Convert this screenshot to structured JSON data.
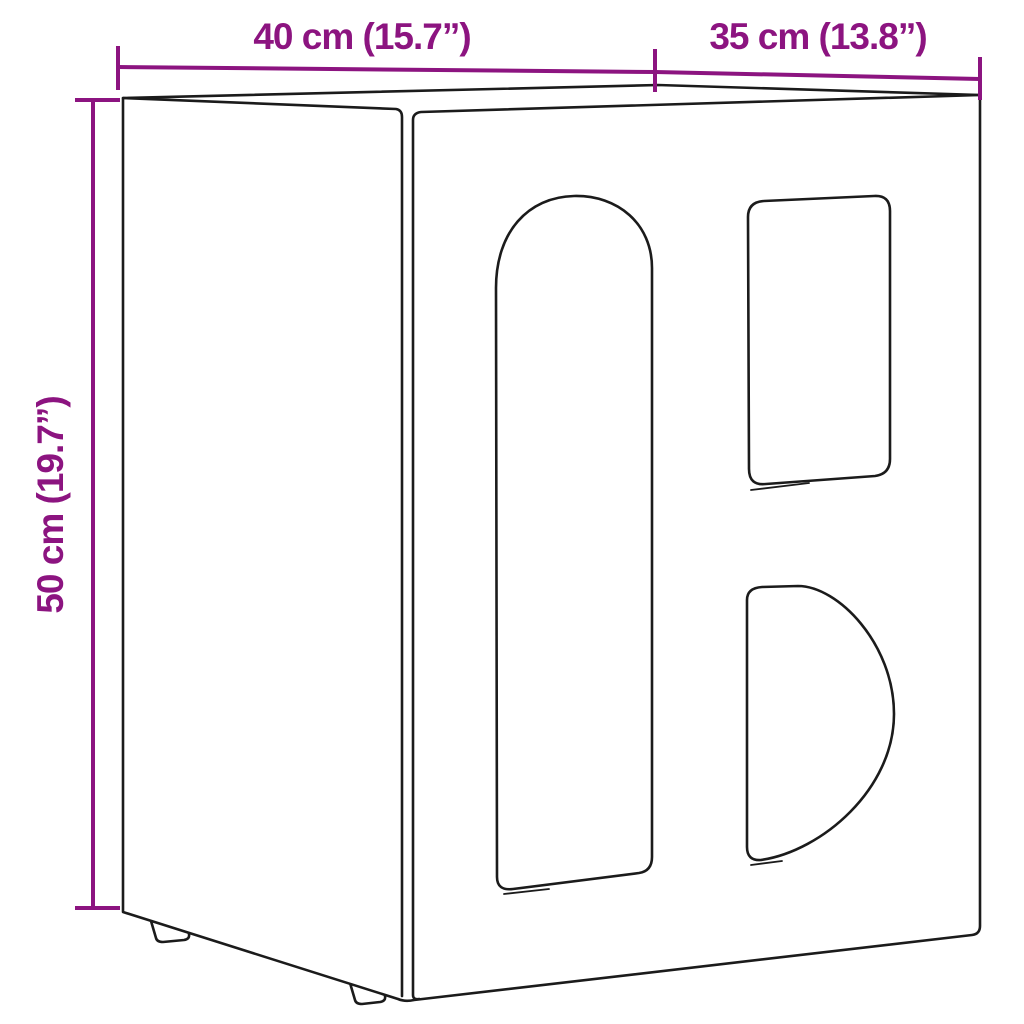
{
  "diagram": {
    "type": "product-dimension-diagram",
    "colors": {
      "dimension": "#8c1480",
      "line": "#1b1b1b",
      "background": "#ffffff"
    },
    "dimensions": {
      "width": {
        "label": "40 cm (15.7”)",
        "value_cm": 40,
        "value_inch": 15.7
      },
      "depth": {
        "label": "35 cm (13.8”)",
        "value_cm": 35,
        "value_inch": 13.8
      },
      "height": {
        "label": "50 cm (19.7”)",
        "value_cm": 50,
        "value_inch": 19.7
      }
    }
  }
}
